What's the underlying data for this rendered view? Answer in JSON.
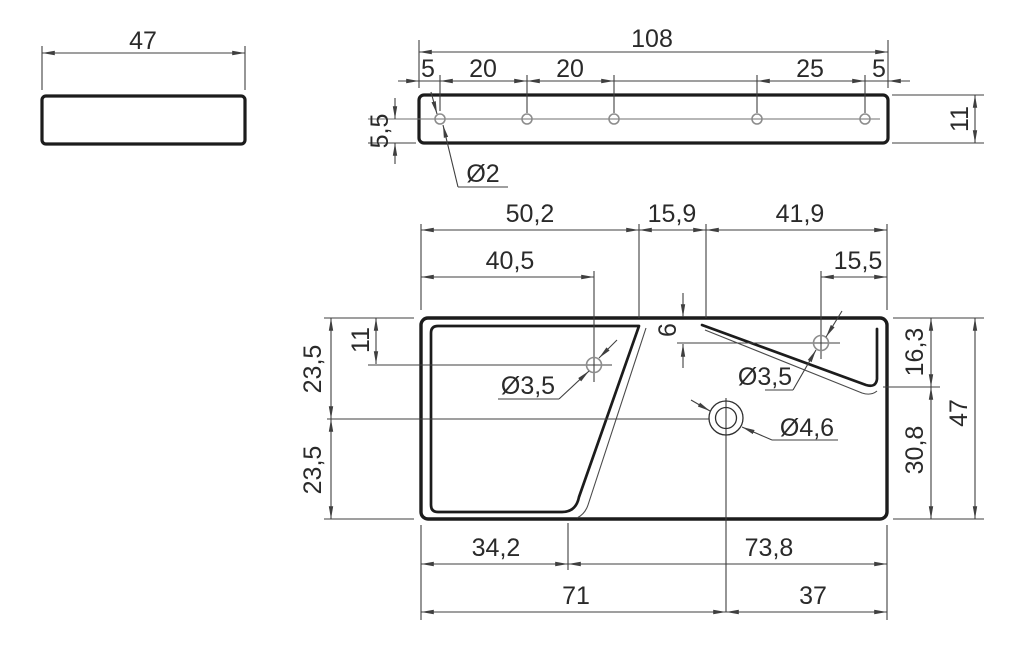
{
  "drawing": {
    "type": "technical-3-view-part-drawing",
    "units_style": "decimal-comma",
    "colors": {
      "background": "#ffffff",
      "part_line": "#1c1c1c",
      "dimension_line": "#3f3f3f",
      "text": "#2a2a2a",
      "hole_line": "#8d8d8d"
    },
    "views": {
      "end_view": {
        "width": "47"
      },
      "side_view": {
        "length": "108",
        "chain": [
          "5",
          "20",
          "20",
          "25",
          "5"
        ],
        "thickness": "11",
        "hole_centerline_offset": "5,5",
        "hole_diameter": "Ø2"
      },
      "front_view": {
        "top": [
          "50,2",
          "15,9",
          "41,9"
        ],
        "hole_x": [
          "40,5",
          "15,5"
        ],
        "left": {
          "hole_y": "11",
          "upper": "23,5",
          "lower": "23,5"
        },
        "slot_offset": "6",
        "holes": {
          "left": "Ø3,5",
          "right": "Ø3,5",
          "center": "Ø4,6"
        },
        "right": {
          "upper": "16,3",
          "lower": "30,8",
          "height": "47"
        },
        "bottom": [
          "34,2",
          "73,8",
          "71",
          "37"
        ]
      }
    }
  }
}
